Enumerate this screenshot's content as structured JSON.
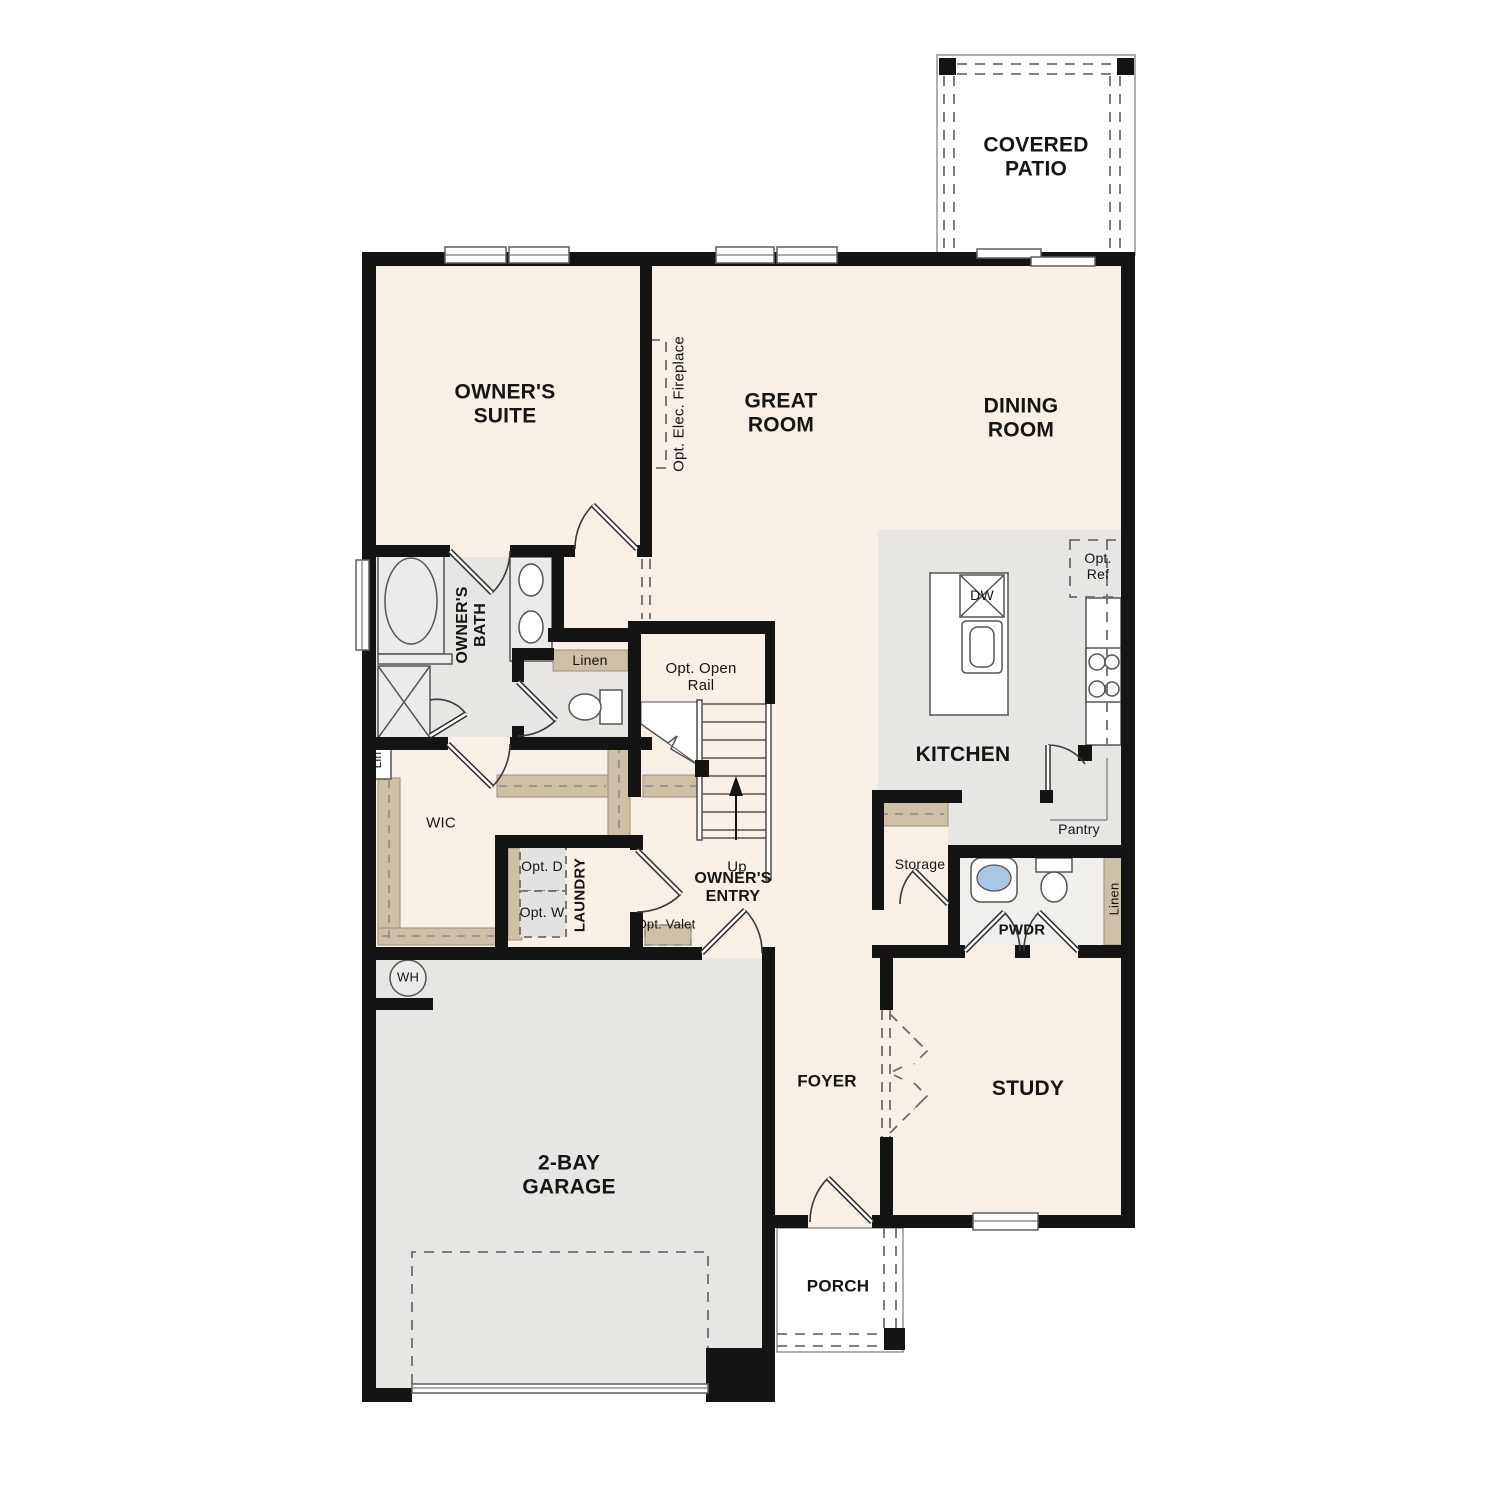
{
  "rooms": {
    "covered_patio": "COVERED PATIO",
    "owners_suite": "OWNER'S SUITE",
    "great_room": "GREAT ROOM",
    "dining_room": "DINING ROOM",
    "owners_bath": "OWNER'S BATH",
    "kitchen": "KITCHEN",
    "wic": "WIC",
    "laundry": "LAUNDRY",
    "owners_entry": "OWNER'S ENTRY",
    "foyer": "FOYER",
    "study": "STUDY",
    "pwdr": "PWDR",
    "garage": "2-BAY GARAGE",
    "porch": "PORCH"
  },
  "annotations": {
    "opt_elec_fireplace": "Opt. Elec. Fireplace",
    "opt_open_rail": "Opt. Open Rail",
    "up": "Up",
    "linen_bath": "Linen",
    "lin": "Lin",
    "opt_d": "Opt. D",
    "opt_w": "Opt. W",
    "opt_valet": "Opt. Valet",
    "wh": "WH",
    "dw": "DW",
    "opt_ref": "Opt. Ref",
    "pantry": "Pantry",
    "storage": "Storage",
    "linen_pwdr": "Linen"
  },
  "colors": {
    "floor": "#f8efe6",
    "hard_floor": "#e7e6e3",
    "wall": "#141414",
    "shelf_tan": "#cdc0a5",
    "fixture_fill": "#ebebeb",
    "sink_blue": "#a9c7e2",
    "line": "#555555"
  }
}
